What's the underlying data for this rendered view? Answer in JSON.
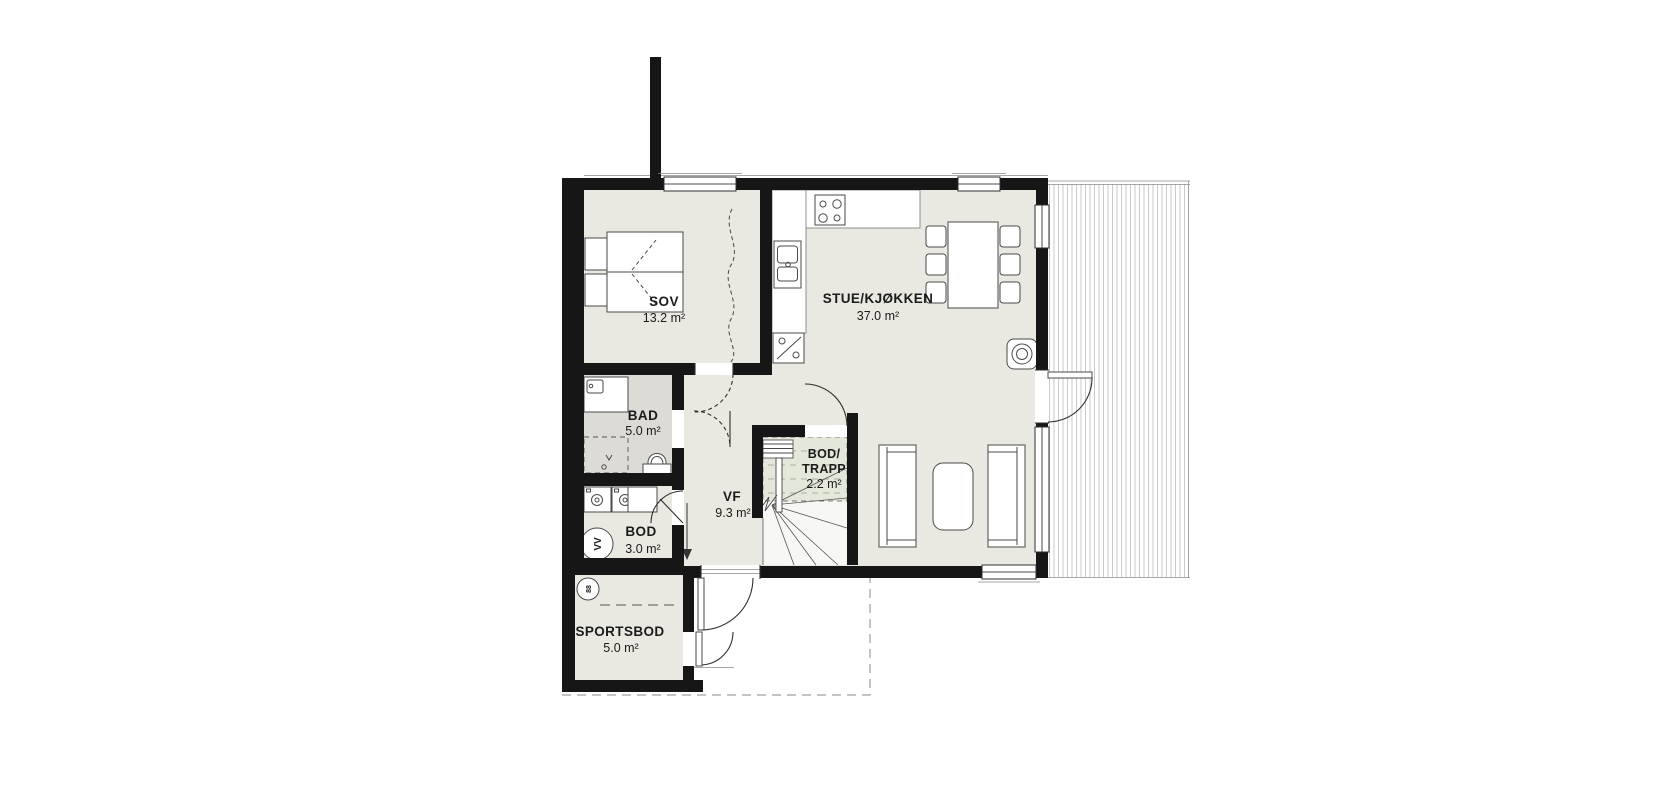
{
  "plan": {
    "type": "floor-plan",
    "rooms": [
      {
        "id": "sov",
        "name": "SOV",
        "area": "13.2 m²"
      },
      {
        "id": "stue",
        "name": "STUE/KJØKKEN",
        "area": "37.0 m²"
      },
      {
        "id": "bad",
        "name": "BAD",
        "area": "5.0 m²"
      },
      {
        "id": "vf",
        "name": "VF",
        "area": "9.3 m²"
      },
      {
        "id": "bod_trapp",
        "name_line1": "BOD/",
        "name_line2": "TRAPP",
        "area": "2.2 m²"
      },
      {
        "id": "bod",
        "name": "BOD",
        "area": "3.0 m²"
      },
      {
        "id": "sportsbod",
        "name": "SPORTSBOD",
        "area": "5.0 m²"
      }
    ],
    "symbols": {
      "water_heater_label": "VV",
      "sportsbod_circle_label": "88"
    },
    "colors": {
      "wall": "#161616",
      "floor": "#e9e8e1",
      "floor_bathroom": "#dcdbd5",
      "floor_under_stairs": "#e4e8da",
      "deck_board_line": "#bdbdbd",
      "fixture_line": "#4a4a4a"
    }
  }
}
